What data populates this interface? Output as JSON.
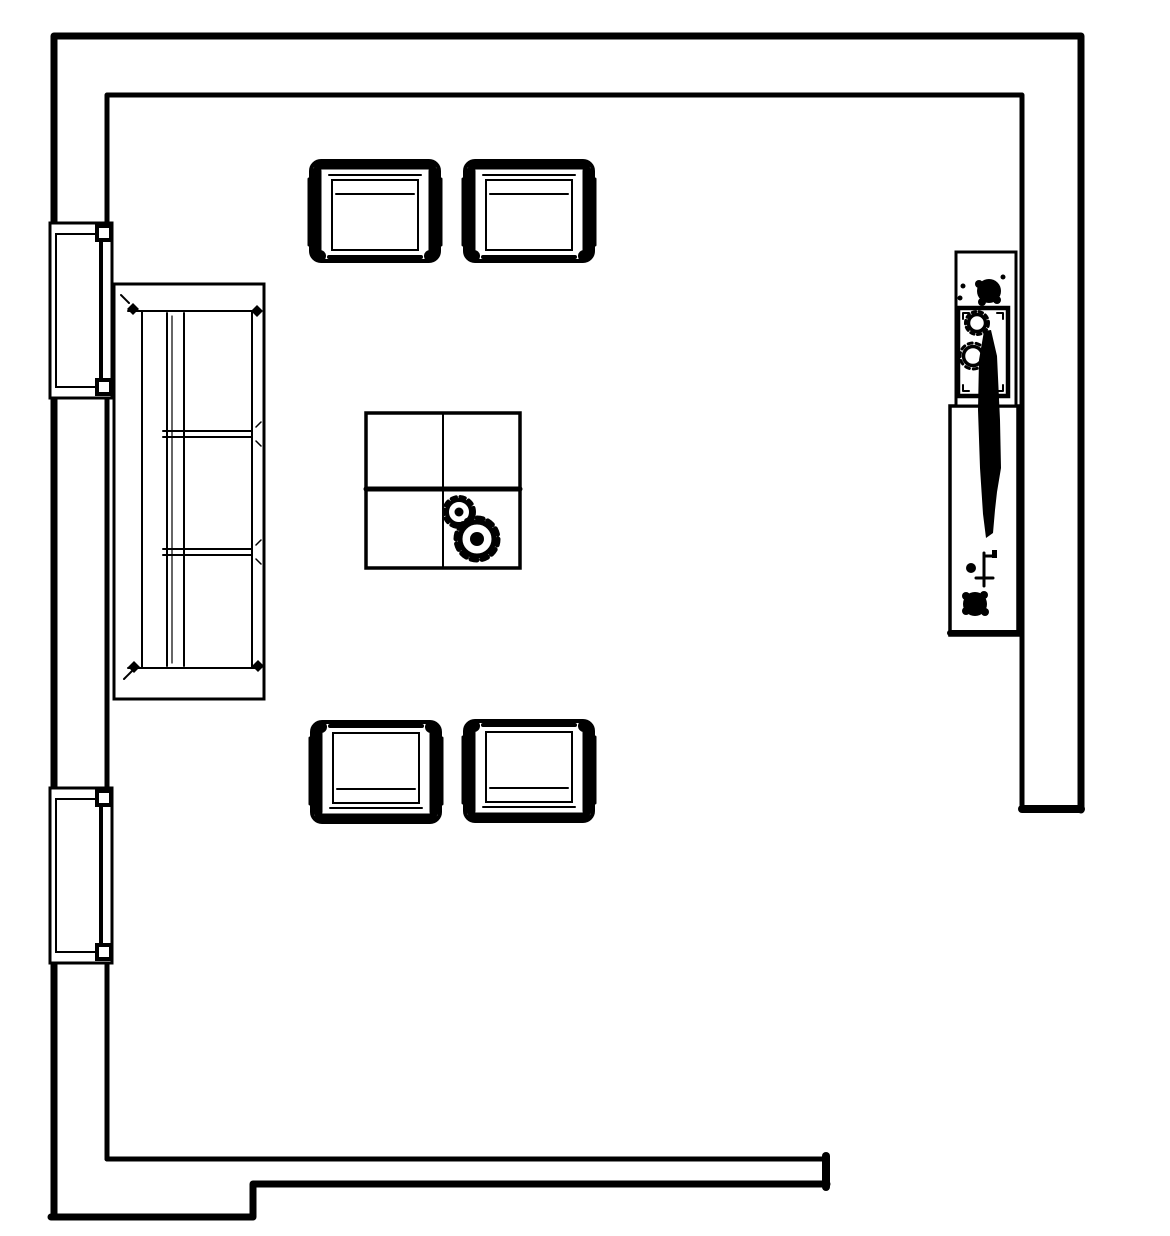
{
  "colors": {
    "ink": "#000000",
    "background": "#ffffff"
  },
  "plan": {
    "type": "floor-plan",
    "room": "living-room",
    "walls": {
      "style": "hollow-double-line",
      "segments": [
        "left-wall",
        "top-wall",
        "right-wall",
        "bottom-wall-stepped"
      ],
      "opening": "bottom-right"
    },
    "windows": [
      {
        "id": "window-upper",
        "wall": "left"
      },
      {
        "id": "window-lower",
        "wall": "left"
      }
    ],
    "furniture": [
      {
        "id": "armchair-top-left",
        "kind": "armchair",
        "facing": "south"
      },
      {
        "id": "armchair-top-right",
        "kind": "armchair",
        "facing": "south"
      },
      {
        "id": "armchair-bottom-left",
        "kind": "armchair",
        "facing": "north"
      },
      {
        "id": "armchair-bottom-right",
        "kind": "armchair",
        "facing": "north"
      },
      {
        "id": "sofa",
        "kind": "three-seat-sofa",
        "facing": "east",
        "seats": 3
      },
      {
        "id": "coffee-table",
        "kind": "square-table",
        "items": [
          "small-plant",
          "large-plant"
        ]
      },
      {
        "id": "console-table",
        "kind": "console",
        "items": [
          "plant",
          "tray-with-two-plants",
          "tall-vase",
          "faucet",
          "plant"
        ]
      }
    ]
  }
}
